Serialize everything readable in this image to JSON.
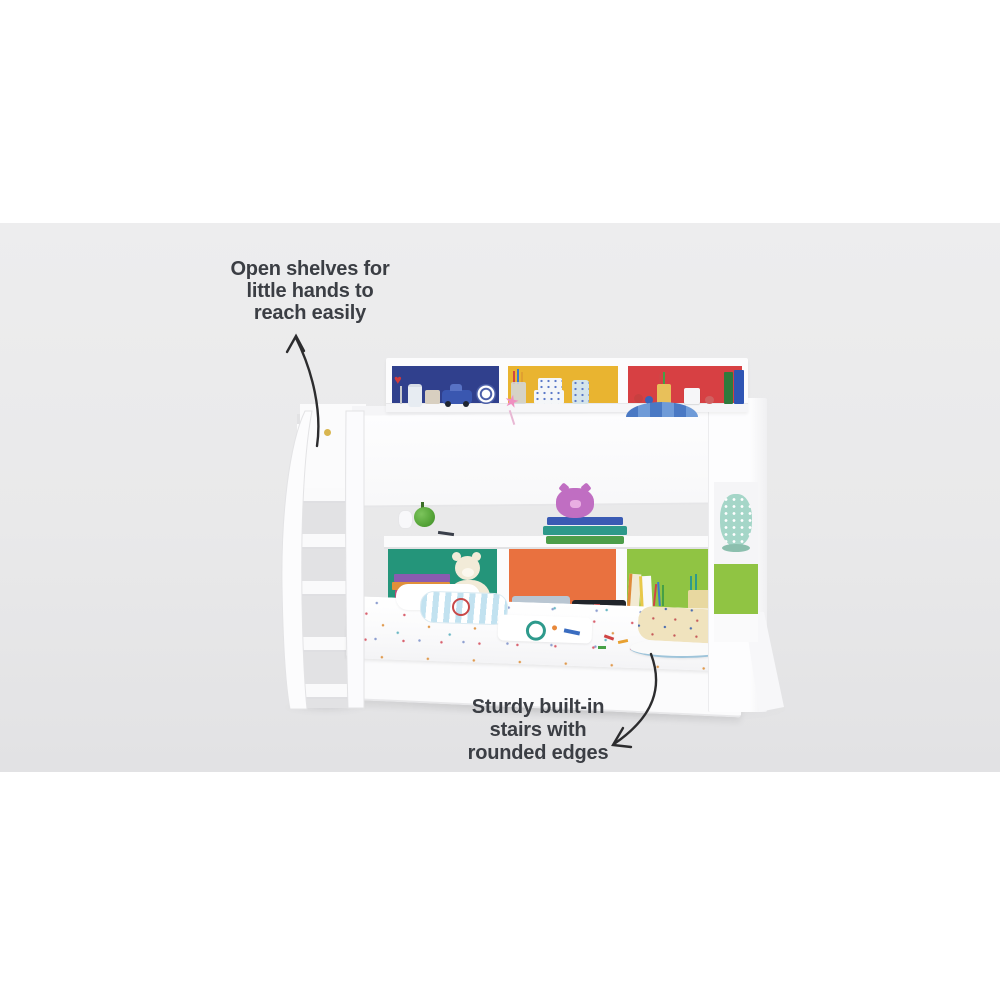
{
  "scene": {
    "letterbox_color": "#ffffff",
    "backdrop_color": "#e9e9ea",
    "furniture_color": "#fcfcfd"
  },
  "annotations": {
    "open_shelves": {
      "line1": "Open shelves for",
      "line2": "little hands to",
      "line3": "reach easily"
    },
    "sturdy_stairs": {
      "line1": "Sturdy built-in",
      "line2": "stairs with",
      "line3": "rounded edges"
    },
    "text_color": "#3b3e44",
    "arrow_color": "#2c2c2e"
  },
  "bed": {
    "top_shelf_panel_colors": {
      "left": "#30408d",
      "middle": "#e9b430",
      "right": "#d74043"
    },
    "bottom_shelf_panel_colors": {
      "left": "#24957a",
      "middle": "#e9713f",
      "right": "#90c443"
    }
  },
  "icons": {
    "heart_toy": "♥",
    "star_wand": "★"
  }
}
